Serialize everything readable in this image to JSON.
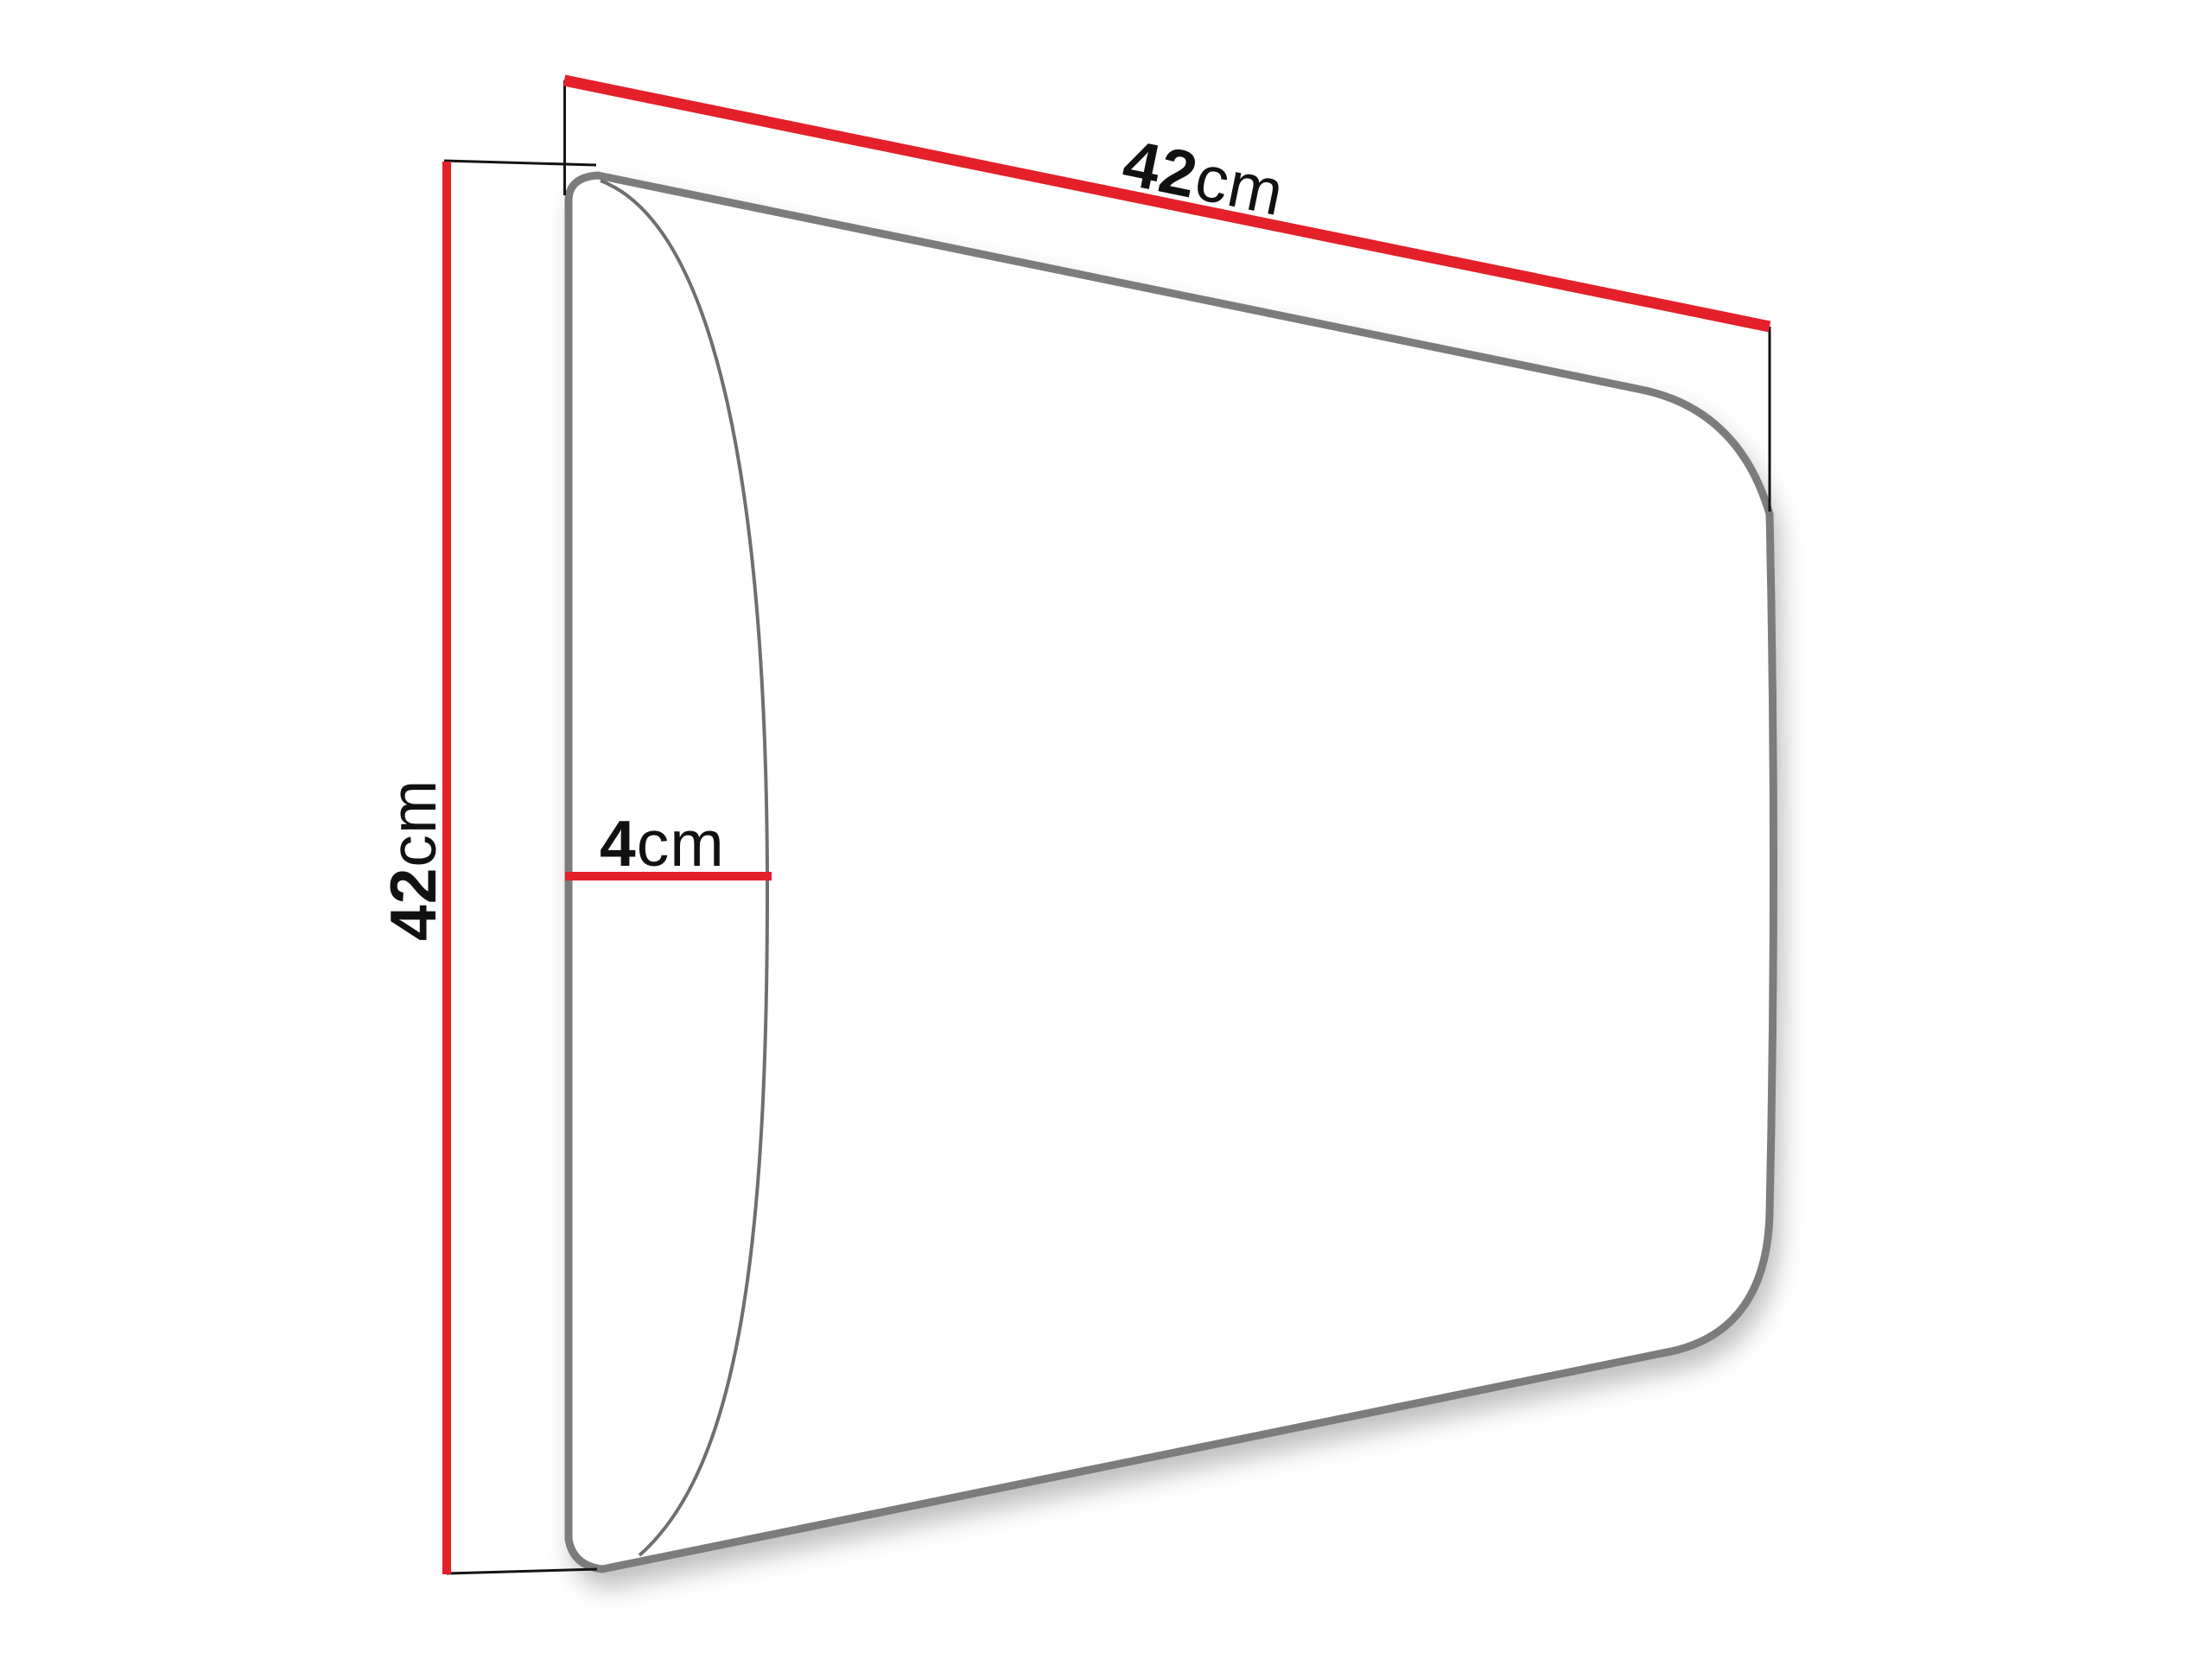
{
  "diagram": {
    "kind": "product-dimension-diagram",
    "dimensions": {
      "width": {
        "value": "42",
        "unit": "cm"
      },
      "height": {
        "value": "42",
        "unit": "cm"
      },
      "depth": {
        "value": "4",
        "unit": "cm"
      }
    },
    "colors": {
      "dimension_line": "#e4202a",
      "panel_outline": "#7c7c7c",
      "cushion_curve": "#6f6f6f",
      "extension_line": "#141414",
      "label_text": "#111111",
      "background": "#ffffff"
    }
  }
}
